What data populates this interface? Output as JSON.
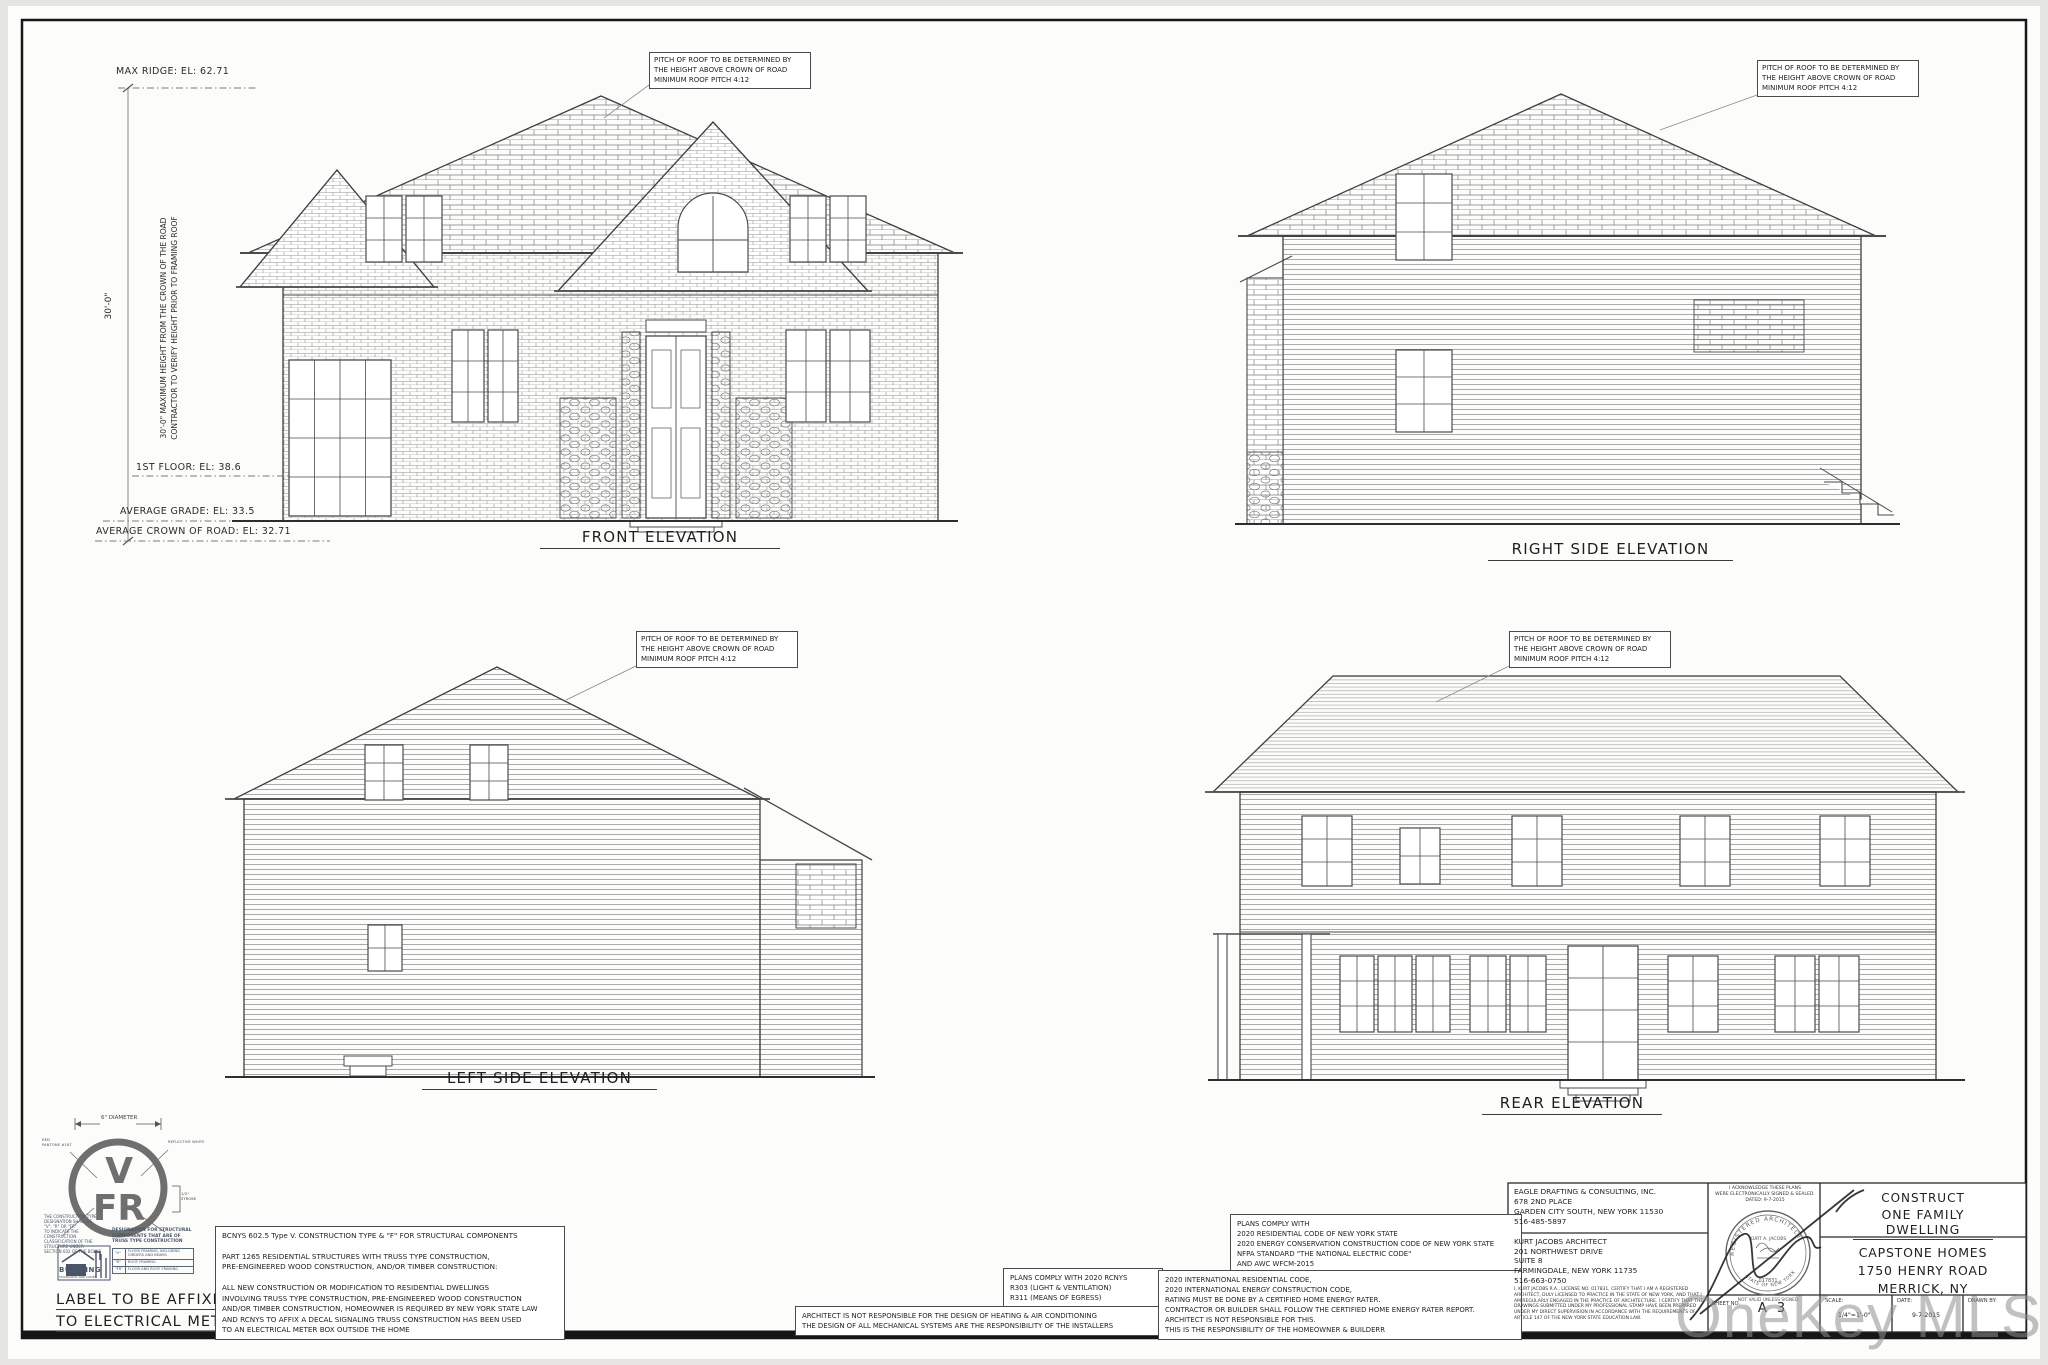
{
  "sheet": {
    "watermark": "OneKey MLS"
  },
  "dims": {
    "max_ridge": "MAX RIDGE: EL: 62.71",
    "height_note": "30'-0\" MAXIMUM HEIGHT FROM THE CROWN OF THE ROAD\nCONTRACTOR TO VERIFY HEIGHT PRIOR TO FRAMING ROOF",
    "overall_height": "30'-0\"",
    "first_floor": "1ST FLOOR: EL: 38.6",
    "avg_grade": "AVERAGE GRADE: EL: 33.5",
    "avg_crown": "AVERAGE CROWN OF ROAD: EL: 32.71",
    "pitch_note": "PITCH OF ROOF TO BE DETERMINED BY\nTHE HEIGHT ABOVE CROWN OF ROAD\nMINIMUM ROOF PITCH 4:12"
  },
  "titles": {
    "front": "FRONT ELEVATION",
    "right_side": "RIGHT SIDE ELEVATION",
    "left_side": "LEFT SIDE ELEVATION",
    "rear": "REAR ELEVATION"
  },
  "truss_decal": {
    "diameter": "6\" DIAMETER",
    "letter_v": "V",
    "letter_fr": "FR",
    "stroke_note": "1/2\"\nSTROKE",
    "red_note": "RED\nPANTONE #187",
    "white_note": "REFLECTIVE WHITE",
    "left_paragraph": "THE CONSTRUCTION TYPE\nDESIGNATION SHALL BE\n\"V\", \"R\" OR \"FR\"\nTO INDICATE THE CONSTRUCTION\nCLASSIFICATION OF THE\nSTRUCTURE UNDER\nSECTION 602 OF THE BCNYS",
    "designation": "DESIGNATION FOR STRUCTURAL\nCOMPONENTS THAT ARE OF\nTRUSS TYPE CONSTRUCTION",
    "table": [
      {
        "code": "\"V\"",
        "desc": "FLOOR FRAMING, INCLUDING GIRDERS AND BEAMS"
      },
      {
        "code": "\"R\"",
        "desc": "ROOF FRAMING"
      },
      {
        "code": "\"FR\"",
        "desc": "FLOOR AND ROOF FRAMING"
      }
    ],
    "logo_line1": "BUILDING",
    "logo_line2": "STANDARDS AND CODES",
    "affix_line1": "LABEL TO BE AFFIXED",
    "affix_line2": "TO ELECTRICAL METER"
  },
  "notes": {
    "bcnys": "BCNYS 602.5 Type V. CONSTRUCTION TYPE & \"F\" FOR STRUCTURAL COMPONENTS\n\nPART 1265 RESIDENTIAL STRUCTURES WITH TRUSS TYPE CONSTRUCTION,\nPRE-ENGINEERED WOOD CONSTRUCTION, AND/OR TIMBER CONSTRUCTION:\n\nALL NEW CONSTRUCTION OR MODIFICATION TO RESIDENTIAL DWELLINGS\nINVOLVING TRUSS TYPE CONSTRUCTION, PRE-ENGINEERED WOOD CONSTRUCTION\nAND/OR TIMBER CONSTRUCTION, HOMEOWNER IS REQUIRED BY NEW YORK STATE LAW\nAND RCNYS TO AFFIX A DECAL SIGNALING TRUSS CONSTRUCTION HAS BEEN USED\nTO AN ELECTRICAL METER BOX OUTSIDE THE HOME",
    "rcnys": "PLANS COMPLY WITH 2020 RCNYS\nR303 (LIGHT & VENTILATION)\nR311 (MEANS OF EGRESS)",
    "architect_resp": "ARCHITECT IS NOT RESPONSIBLE FOR THE DESIGN OF HEATING & AIR CONDITIONING\nTHE DESIGN OF ALL MECHANICAL SYSTEMS ARE THE RESPONSIBILITY OF THE INSTALLERS",
    "comply": "PLANS COMPLY WITH\n2020 RESIDENTIAL CODE OF NEW YORK STATE\n2020 ENERGY CONSERVATION CONSTRUCTION CODE OF NEW YORK STATE\nNFPA STANDARD \"THE NATIONAL ELECTRIC CODE\"\nAND AWC WFCM-2015",
    "energy": "2020 INTERNATIONAL RESIDENTIAL CODE,\n2020 INTERNATIONAL ENERGY CONSTRUCTION CODE,\nRATING MUST BE DONE BY A CERTIFIED HOME ENERGY RATER.\nCONTRACTOR OR BUILDER SHALL FOLLOW THE CERTIFIED HOME ENERGY RATER REPORT.\nARCHITECT IS NOT RESPONSIBLE FOR THIS.\nTHIS IS THE RESPONSIBILITY OF THE HOMEOWNER & BUILDERR"
  },
  "titleblock": {
    "firm": "EAGLE DRAFTING & CONSULTING, INC.\n678 2ND PLACE\nGARDEN CITY SOUTH, NEW YORK 11530\n516-485-5897",
    "architect": "KURT JACOBS ARCHITECT\n201 NORTHWEST DRIVE\nSUITE 8\nFARMINGDALE, NEW YORK 11735\n516-663-0750",
    "certification": "I, KURT JACOBS R.A., LICENSE NO. 017831, CERTIFY THAT I AM A REGISTERED ARCHITECT, DULY LICENSED TO PRACTICE IN THE STATE OF NEW YORK, AND THAT I AM REGULARLY ENGAGED IN THE PRACTICE OF ARCHITECTURE. I CERTIFY THAT THE DRAWINGS SUBMITTED UNDER MY PROFESSIONAL STAMP HAVE BEEN PREPARED UNDER MY DIRECT SUPERVISION IN ACCORDANCE WITH THE REQUIREMENTS OF ARTICLE 147 OF THE NEW YORK STATE EDUCATION LAW.",
    "acknowledge": "I ACKNOWLEDGE THESE PLANS\nWERE ELECTRONICALLY SIGNED & SEALED.\nDATED: 9-7-2015",
    "seal_top": "REGISTERED ARCHITECT",
    "seal_name": "KURT A. JACOBS",
    "seal_number": "017831",
    "seal_bottom": "STATE OF NEW YORK",
    "seal_not_valid": "NOT VALID UNLESS SIGNED",
    "construct1": "CONSTRUCT",
    "construct2": "ONE FAMILY DWELLING",
    "client": "CAPSTONE HOMES\n1750 HENRY ROAD\nMERRICK, NY",
    "sheet_no_label": "SHEET NO.",
    "sheet_no": "A 3",
    "scale_label": "SCALE:",
    "scale_value": "1/4\"=1'-0\"",
    "date_label": "DATE:",
    "date_value": "9-7-2015",
    "drawn_label": "DRAWN BY:"
  }
}
